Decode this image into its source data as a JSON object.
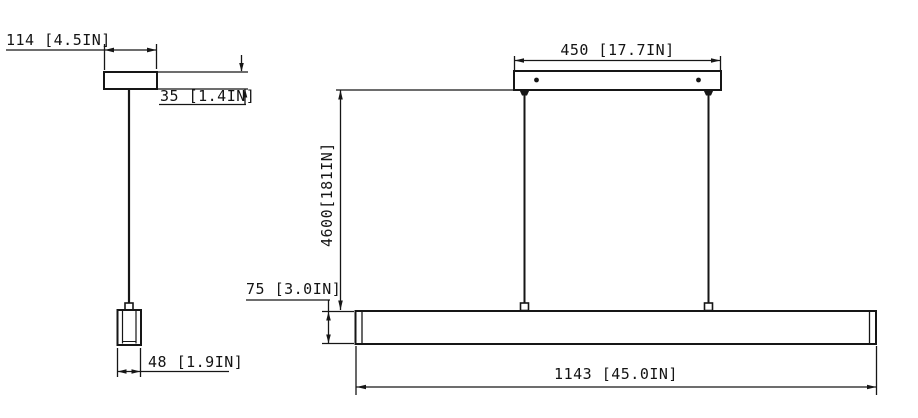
{
  "drawing": {
    "background": "#ffffff",
    "line_color": "#161616",
    "type": "linear-pendant-lamp-dimension-drawing"
  },
  "side_view": {
    "canopy_width": "114 [4.5IN]",
    "canopy_height": "35 [1.4IN]",
    "fixture_width": "48 [1.9IN]"
  },
  "front_view": {
    "canopy_width": "450 [17.7IN]",
    "suspension_height": "4600[181IN]",
    "fixture_height": "75 [3.0IN]",
    "fixture_length": "1143 [45.0IN]"
  }
}
